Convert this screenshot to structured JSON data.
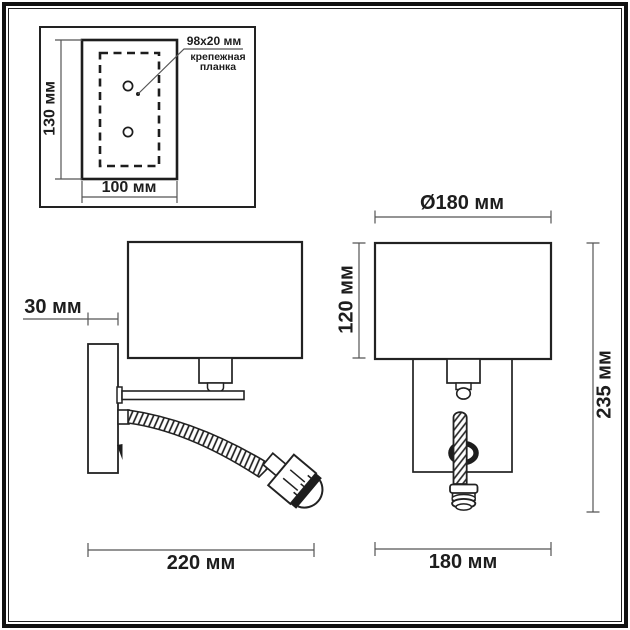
{
  "inset": {
    "height_label": "130 мм",
    "width_label": "100 мм",
    "leader_size_label": "98x20 мм",
    "leader_name_label": "крепежная планка"
  },
  "side_view": {
    "plate_depth_label": "30 мм",
    "total_depth_label": "220 мм"
  },
  "front_view": {
    "shade_diameter_label": "Ø180 мм",
    "shade_height_label": "120 мм",
    "width_label": "180 мм",
    "total_height_label": "235 мм"
  },
  "colors": {
    "line": "#222222",
    "dimension_line": "#555555",
    "background": "#ffffff"
  }
}
